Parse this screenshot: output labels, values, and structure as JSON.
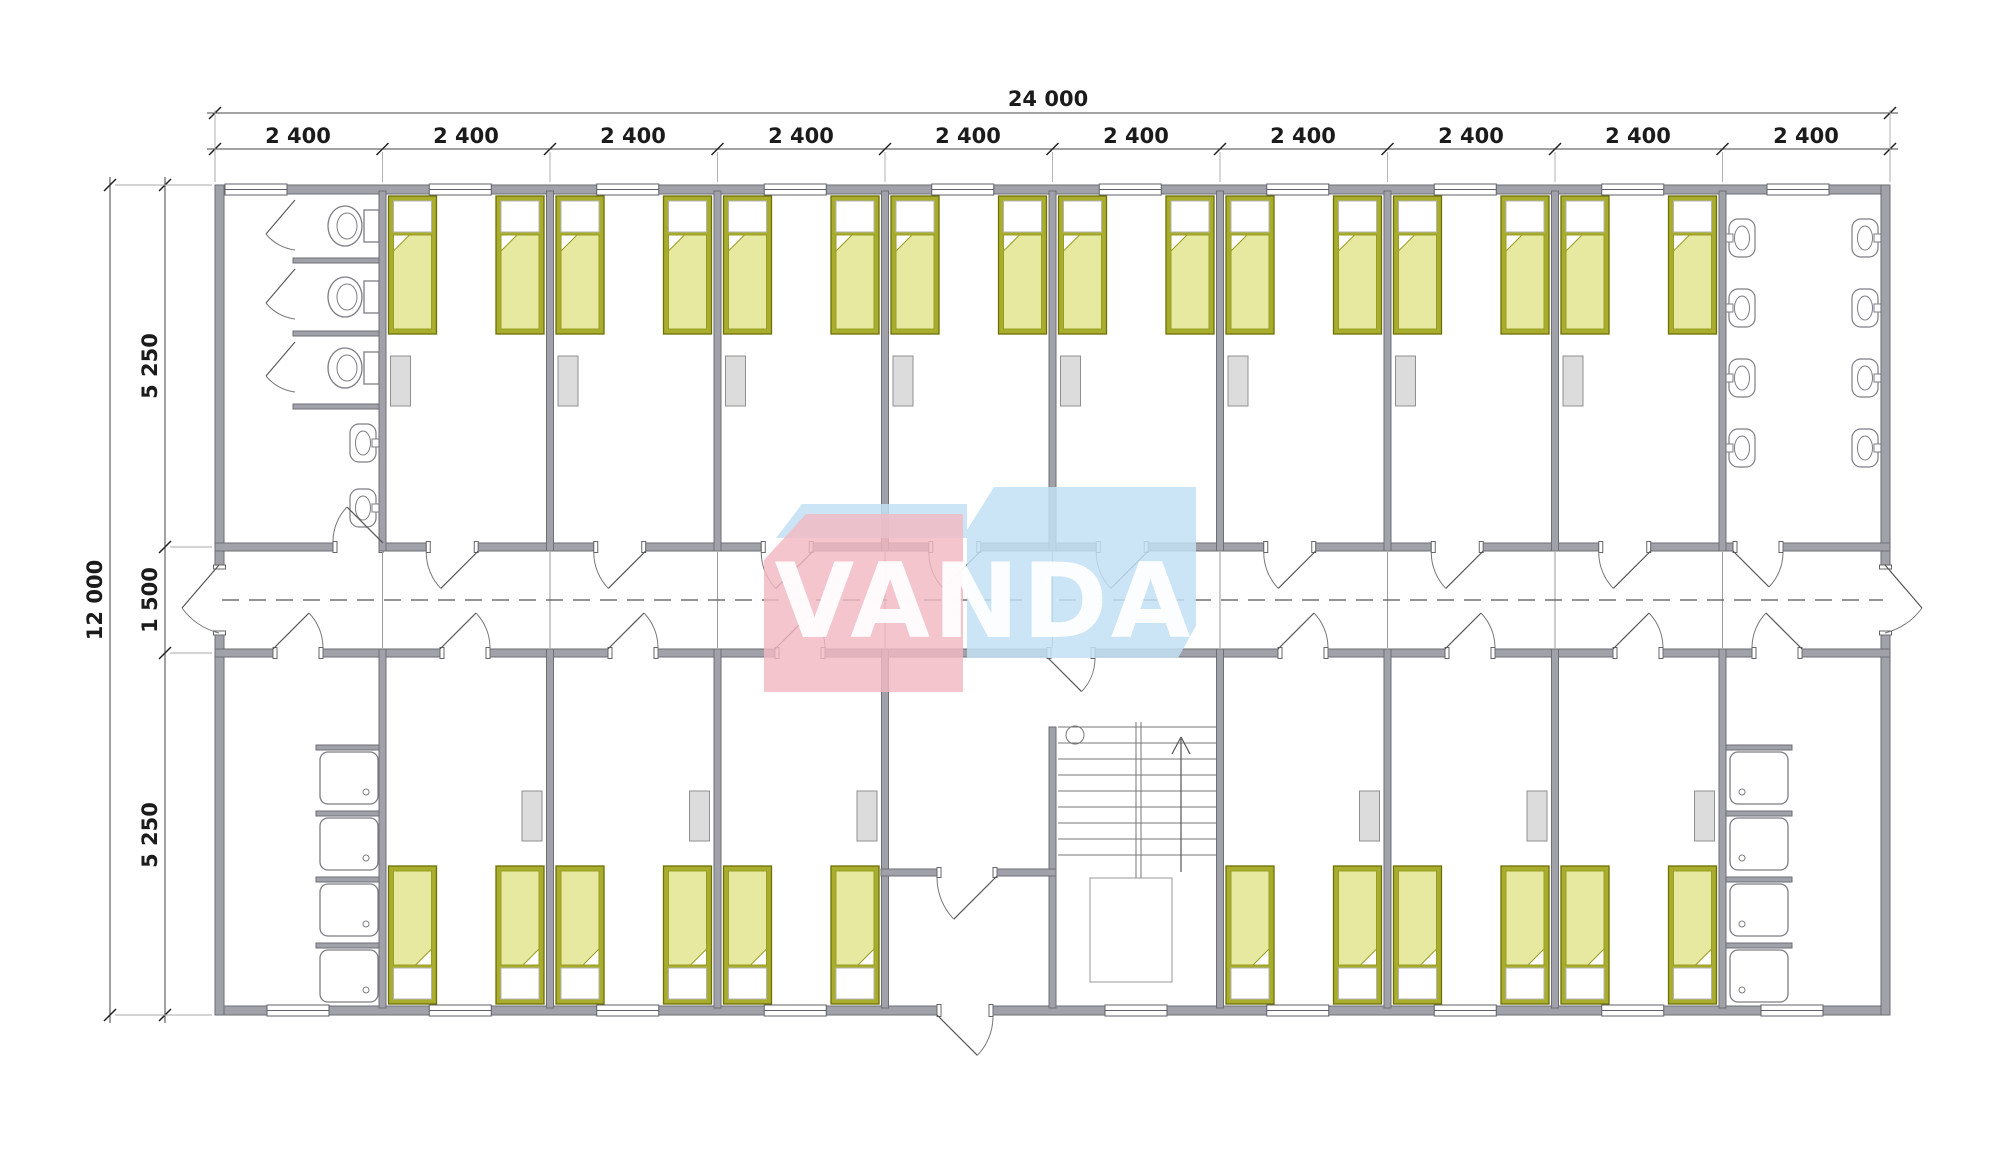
{
  "watermark": {
    "text": "VANDA",
    "pink_color": "#f2b8c2",
    "blue_color": "#c2e1f4"
  },
  "dimensions": {
    "units": "mm",
    "top_total": "24 000",
    "top_modules": [
      "2 400",
      "2 400",
      "2 400",
      "2 400",
      "2 400",
      "2 400",
      "2 400",
      "2 400",
      "2 400",
      "2 400"
    ],
    "left_total": "12 000",
    "left_segments": [
      "5 250",
      "1 500",
      "5 250"
    ]
  },
  "plan": {
    "building": {
      "width_mm": 24000,
      "depth_mm": 12000,
      "corridor_mm": 1500,
      "room_band_mm": 5250,
      "modules": 10
    },
    "colors": {
      "wall": "#a1a1a9",
      "wall_edge": "#6e6e76",
      "bed_frame": "#a9ad2e",
      "bed_frame_edge": "#6d7004",
      "bed_blanket": "#e7e9a0",
      "bed_blanket_edge": "#9a9e22",
      "pillow": "#ffffff",
      "locker": "#dcdcdc",
      "locker_edge": "#909090",
      "fixture_stroke": "#7d7d85",
      "door_stroke": "#555555",
      "dash_line": "#555555",
      "dim_line": "#444444",
      "dim_text": "#1b1b1b"
    },
    "rooms_top": [
      {
        "name": "toilet-room",
        "fixtures": {
          "toilet_stalls": 3,
          "wash_basins": 2
        }
      },
      {
        "name": "bedroom",
        "beds": 2,
        "lockers": 1
      },
      {
        "name": "bedroom",
        "beds": 2,
        "lockers": 1
      },
      {
        "name": "bedroom",
        "beds": 2,
        "lockers": 1
      },
      {
        "name": "bedroom",
        "beds": 2,
        "lockers": 1
      },
      {
        "name": "bedroom",
        "beds": 2,
        "lockers": 1
      },
      {
        "name": "bedroom",
        "beds": 2,
        "lockers": 1
      },
      {
        "name": "bedroom",
        "beds": 2,
        "lockers": 1
      },
      {
        "name": "bedroom",
        "beds": 2,
        "lockers": 1
      },
      {
        "name": "washroom",
        "fixtures": {
          "wash_basins": 8
        }
      }
    ],
    "rooms_bottom": [
      {
        "name": "shower-room",
        "fixtures": {
          "showers": 4
        }
      },
      {
        "name": "bedroom",
        "beds": 2,
        "lockers": 1
      },
      {
        "name": "bedroom",
        "beds": 2,
        "lockers": 1
      },
      {
        "name": "bedroom",
        "beds": 2,
        "lockers": 1
      },
      {
        "name": "entrance-vestibule",
        "fixtures": {
          "exterior_door": 1
        }
      },
      {
        "name": "staircase",
        "fixtures": {
          "stair_flights": 2
        }
      },
      {
        "name": "bedroom",
        "beds": 2,
        "lockers": 1
      },
      {
        "name": "bedroom",
        "beds": 2,
        "lockers": 1
      },
      {
        "name": "bedroom",
        "beds": 2,
        "lockers": 1
      },
      {
        "name": "shower-room",
        "fixtures": {
          "showers": 4
        }
      }
    ],
    "totals": {
      "beds": 28,
      "lockers": 14,
      "toilets": 3,
      "wash_basins": 10,
      "showers": 8,
      "corridor_exit_doors": 2
    }
  }
}
